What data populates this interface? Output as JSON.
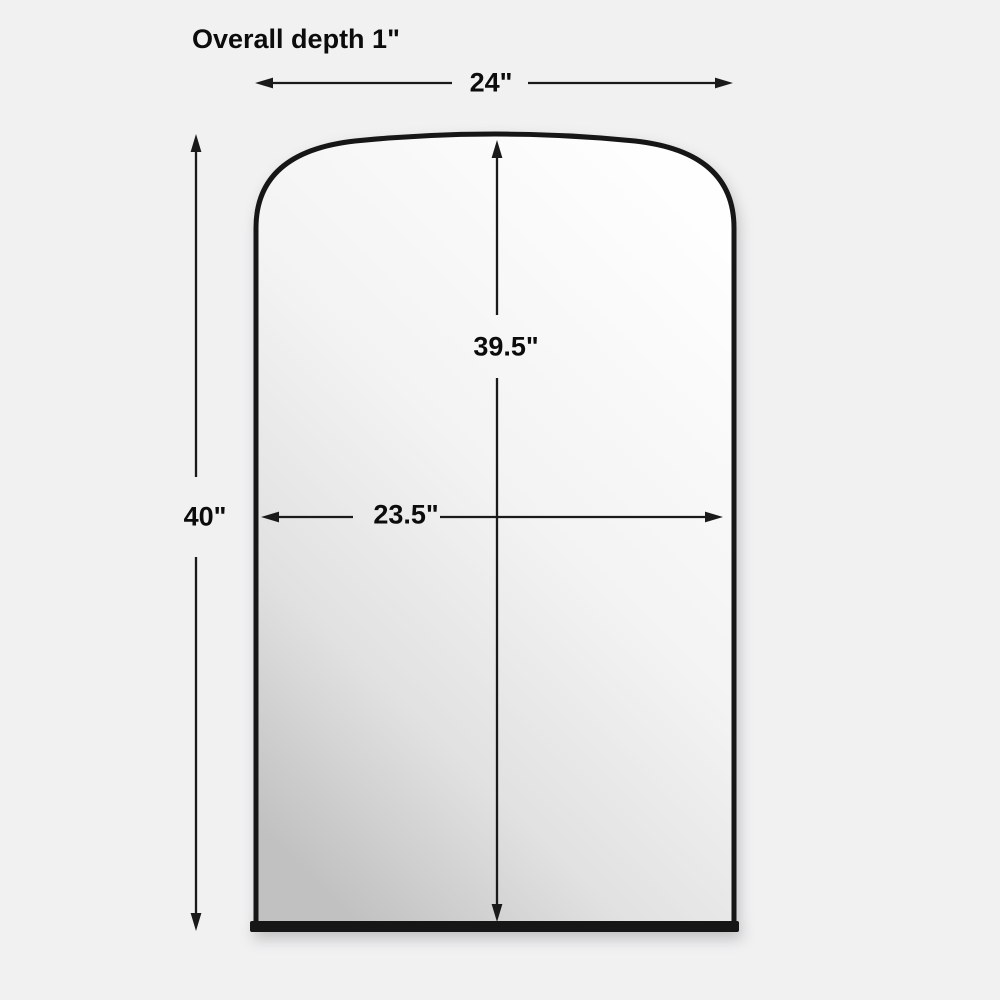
{
  "page": {
    "background_color": "#f1f1f2"
  },
  "diagram": {
    "title": "Overall depth 1\"",
    "product": "arched-mirror",
    "dimensions": {
      "overall_width": "24\"",
      "overall_height": "40\"",
      "mirror_height": "39.5\"",
      "mirror_width": "23.5\""
    },
    "colors": {
      "frame": "#151515",
      "dimension_line": "#1a1a1a",
      "text": "#0c0c0c",
      "glass_top": "#fdfdfd",
      "glass_bottom": "#c1c1c1"
    }
  }
}
